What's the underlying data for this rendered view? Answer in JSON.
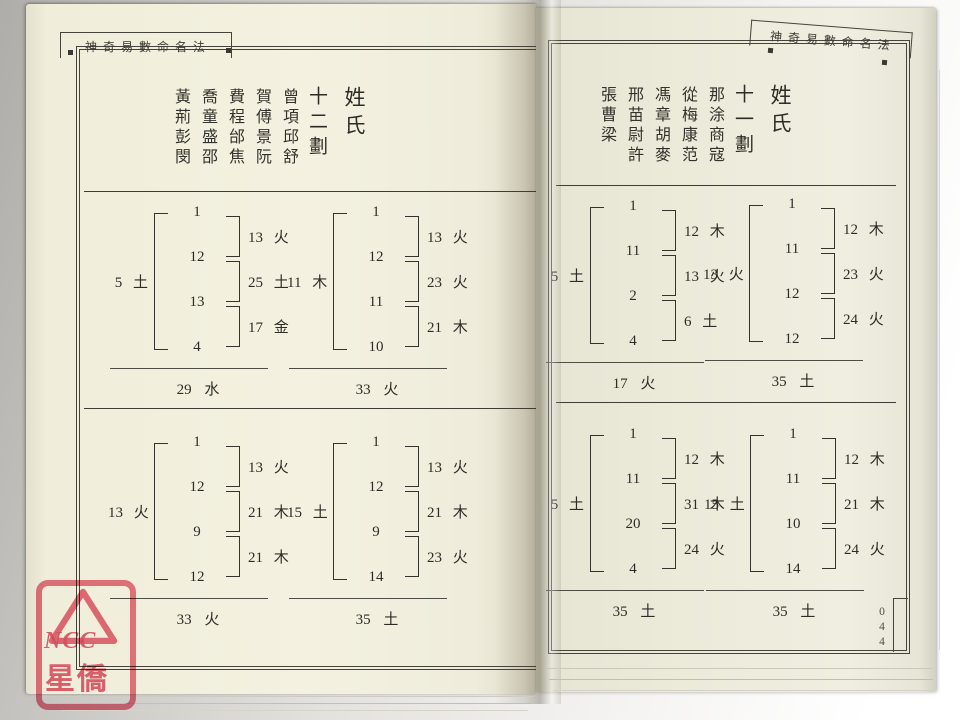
{
  "book": {
    "header_title": "神奇易數命名法",
    "page_number": "044"
  },
  "watermark": {
    "line1": "NCC",
    "line2": "星僑",
    "stamp_color": "#e2465f"
  },
  "colors": {
    "ink": "#2e2c27",
    "paper_left": "#f3f0df",
    "paper_right": "#ecead9"
  },
  "pages": [
    {
      "side": "left",
      "title": "姓氏",
      "subtitle": "十二劃",
      "surname_columns": [
        "曾項邱舒",
        "賀傅景阮",
        "費程邰焦",
        "喬童盛邵",
        "黃荊彭閔"
      ],
      "diagrams": [
        {
          "numbers": [
            "1",
            "12",
            "13",
            "4"
          ],
          "left": {
            "num": "5",
            "el": "土"
          },
          "right": [
            {
              "num": "13",
              "el": "火"
            },
            {
              "num": "25",
              "el": "土"
            },
            {
              "num": "17",
              "el": "金"
            }
          ],
          "total": {
            "num": "29",
            "el": "水"
          }
        },
        {
          "numbers": [
            "1",
            "12",
            "11",
            "10"
          ],
          "left": {
            "num": "11",
            "el": "木"
          },
          "right": [
            {
              "num": "13",
              "el": "火"
            },
            {
              "num": "23",
              "el": "火"
            },
            {
              "num": "21",
              "el": "木"
            }
          ],
          "total": {
            "num": "33",
            "el": "火"
          }
        },
        {
          "numbers": [
            "1",
            "12",
            "9",
            "12"
          ],
          "left": {
            "num": "13",
            "el": "火"
          },
          "right": [
            {
              "num": "13",
              "el": "火"
            },
            {
              "num": "21",
              "el": "木"
            },
            {
              "num": "21",
              "el": "木"
            }
          ],
          "total": {
            "num": "33",
            "el": "火"
          }
        },
        {
          "numbers": [
            "1",
            "12",
            "9",
            "14"
          ],
          "left": {
            "num": "15",
            "el": "土"
          },
          "right": [
            {
              "num": "13",
              "el": "火"
            },
            {
              "num": "21",
              "el": "木"
            },
            {
              "num": "23",
              "el": "火"
            }
          ],
          "total": {
            "num": "35",
            "el": "土"
          }
        }
      ]
    },
    {
      "side": "right",
      "title": "姓氏",
      "subtitle": "十一劃",
      "surname_columns": [
        "那涂商寇",
        "從梅康范",
        "馮章胡麥",
        "邢苗尉許",
        "張曹梁"
      ],
      "diagrams": [
        {
          "numbers": [
            "1",
            "11",
            "2",
            "4"
          ],
          "left": {
            "num": "5",
            "el": "土"
          },
          "right": [
            {
              "num": "12",
              "el": "木"
            },
            {
              "num": "13",
              "el": "火"
            },
            {
              "num": "6",
              "el": "土"
            }
          ],
          "total": {
            "num": "17",
            "el": "火"
          }
        },
        {
          "numbers": [
            "1",
            "11",
            "12",
            "12"
          ],
          "left": {
            "num": "13",
            "el": "火"
          },
          "right": [
            {
              "num": "12",
              "el": "木"
            },
            {
              "num": "23",
              "el": "火"
            },
            {
              "num": "24",
              "el": "火"
            }
          ],
          "total": {
            "num": "35",
            "el": "土"
          }
        },
        {
          "numbers": [
            "1",
            "11",
            "20",
            "4"
          ],
          "left": {
            "num": "5",
            "el": "土"
          },
          "right": [
            {
              "num": "12",
              "el": "木"
            },
            {
              "num": "31",
              "el": "木"
            },
            {
              "num": "24",
              "el": "火"
            }
          ],
          "total": {
            "num": "35",
            "el": "土"
          }
        },
        {
          "numbers": [
            "1",
            "11",
            "10",
            "14"
          ],
          "left": {
            "num": "15",
            "el": "土"
          },
          "right": [
            {
              "num": "12",
              "el": "木"
            },
            {
              "num": "21",
              "el": "木"
            },
            {
              "num": "24",
              "el": "火"
            }
          ],
          "total": {
            "num": "35",
            "el": "土"
          }
        }
      ]
    }
  ]
}
